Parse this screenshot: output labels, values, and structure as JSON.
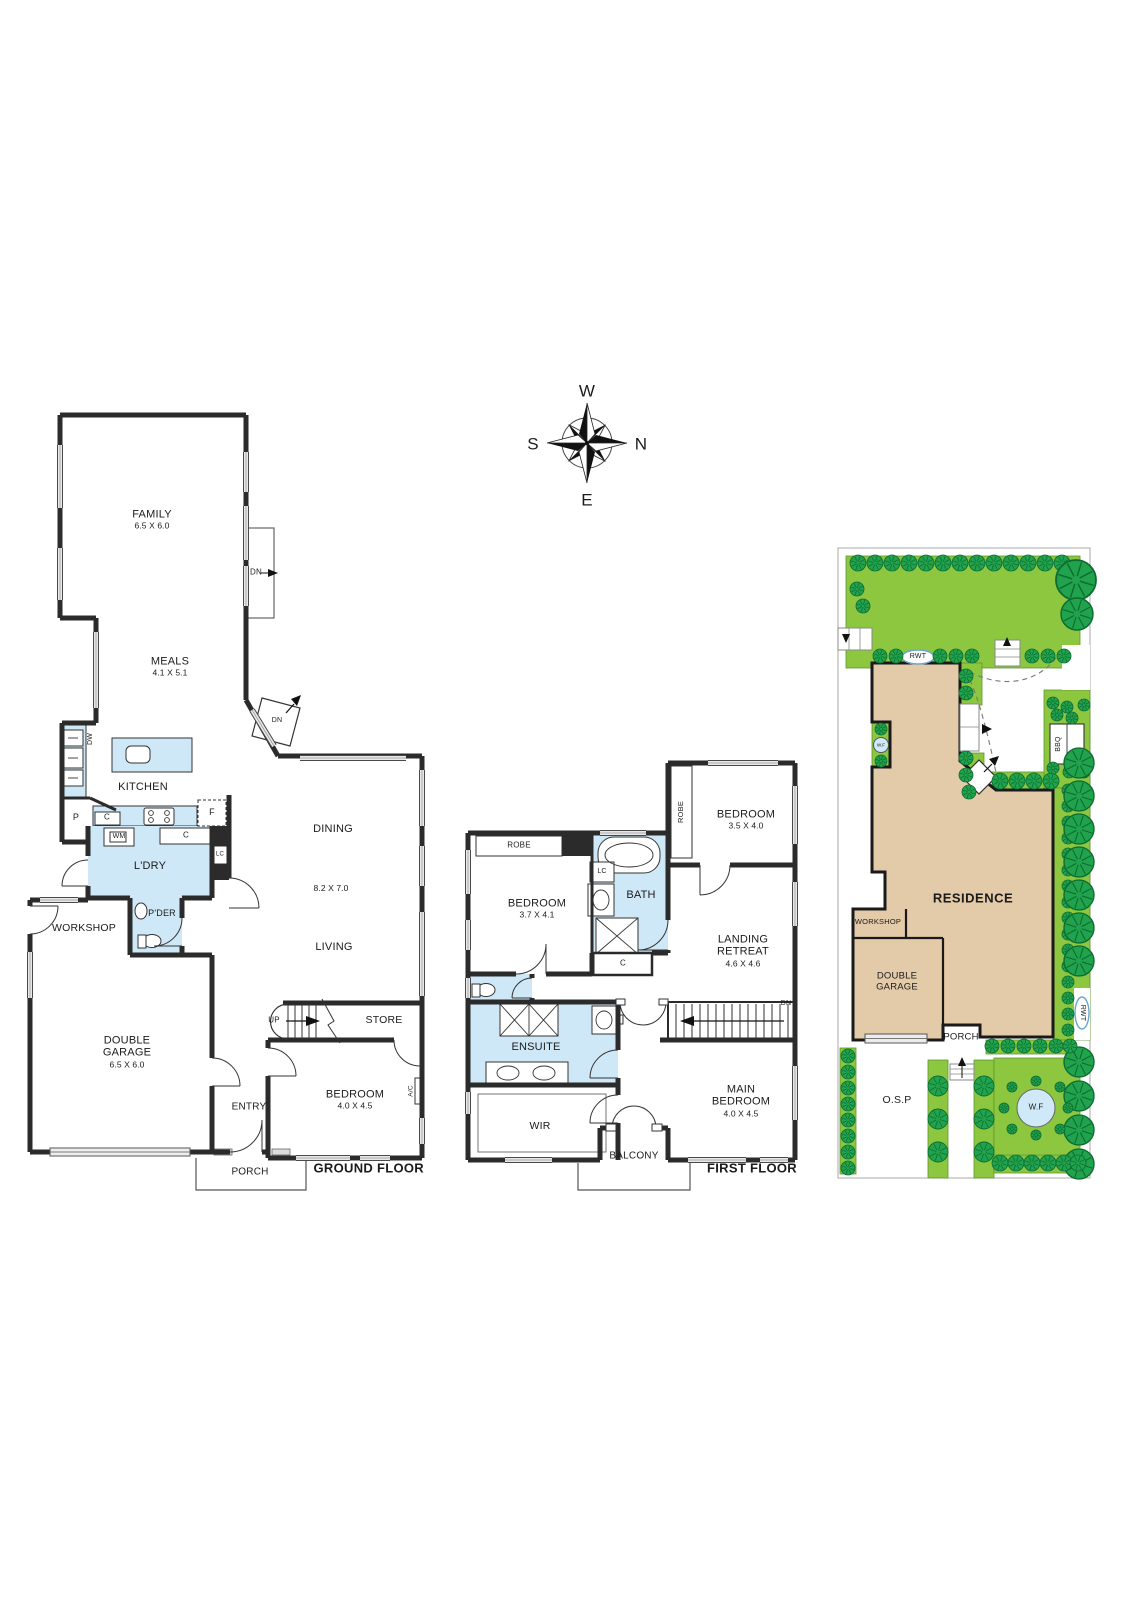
{
  "compass": {
    "west": "W",
    "north": "N",
    "east": "E",
    "south": "S"
  },
  "ground_floor": {
    "title": "GROUND FLOOR",
    "rooms": {
      "family": {
        "name": "FAMILY",
        "dims": "6.5 X 6.0"
      },
      "meals": {
        "name": "MEALS",
        "dims": "4.1 X 5.1"
      },
      "kitchen": {
        "name": "KITCHEN"
      },
      "laundry": {
        "name": "L'DRY"
      },
      "powder": {
        "name": "P'DER"
      },
      "workshop": {
        "name": "WORKSHOP"
      },
      "dining": {
        "name": "DINING"
      },
      "living": {
        "name": "LIVING",
        "dims": "8.2 X 7.0"
      },
      "garage": {
        "name": "DOUBLE GARAGE",
        "dims": "6.5 X 6.0"
      },
      "entry": {
        "name": "ENTRY"
      },
      "porch": {
        "name": "PORCH"
      },
      "bedroom": {
        "name": "BEDROOM",
        "dims": "4.0 X 4.5"
      },
      "store": {
        "name": "STORE"
      }
    },
    "fixtures": {
      "dishwasher": "DW",
      "pantry": "P",
      "cupboard1": "C",
      "fridge": "F",
      "washing_machine": "WM",
      "cupboard2": "C",
      "linen": "LC",
      "stairs_up": "UP",
      "down_family": "DN",
      "down_meals": "DN",
      "aircon": "A/C"
    }
  },
  "first_floor": {
    "title": "FIRST FLOOR",
    "rooms": {
      "bedroom2": {
        "name": "BEDROOM",
        "dims": "3.7 X 4.1"
      },
      "bedroom3": {
        "name": "BEDROOM",
        "dims": "3.5 X 4.0"
      },
      "bath": {
        "name": "BATH"
      },
      "landing": {
        "name": "LANDING RETREAT",
        "dims": "4.6 X 4.6"
      },
      "ensuite": {
        "name": "ENSUITE"
      },
      "wir": {
        "name": "WIR"
      },
      "balcony": {
        "name": "BALCONY"
      },
      "main_bedroom": {
        "name": "MAIN BEDROOM",
        "dims": "4.0 X 4.5"
      }
    },
    "fixtures": {
      "robe1": "ROBE",
      "robe2": "ROBE",
      "linen": "LC",
      "cupboard": "C",
      "stairs_down": "DN"
    }
  },
  "site_plan": {
    "residence": "RESIDENCE",
    "workshop": "WORKSHOP",
    "garage": "DOUBLE GARAGE",
    "porch": "PORCH",
    "osp": "O.S.P",
    "water_feature_small": "W.F",
    "water_feature_large": "W.F",
    "rainwater_tank_top": "RWT",
    "rainwater_tank_side": "RWT",
    "bbq": "BBQ"
  },
  "colors": {
    "wall": "#2b2b2b",
    "wet_area": "#cfe8f7",
    "lawn": "#8dc63f",
    "tree": "#21a24c",
    "tree_outline": "#0c6b31",
    "residence": "#e3caa9",
    "water": "#cfe9f8",
    "window": "#e8e8e8"
  }
}
